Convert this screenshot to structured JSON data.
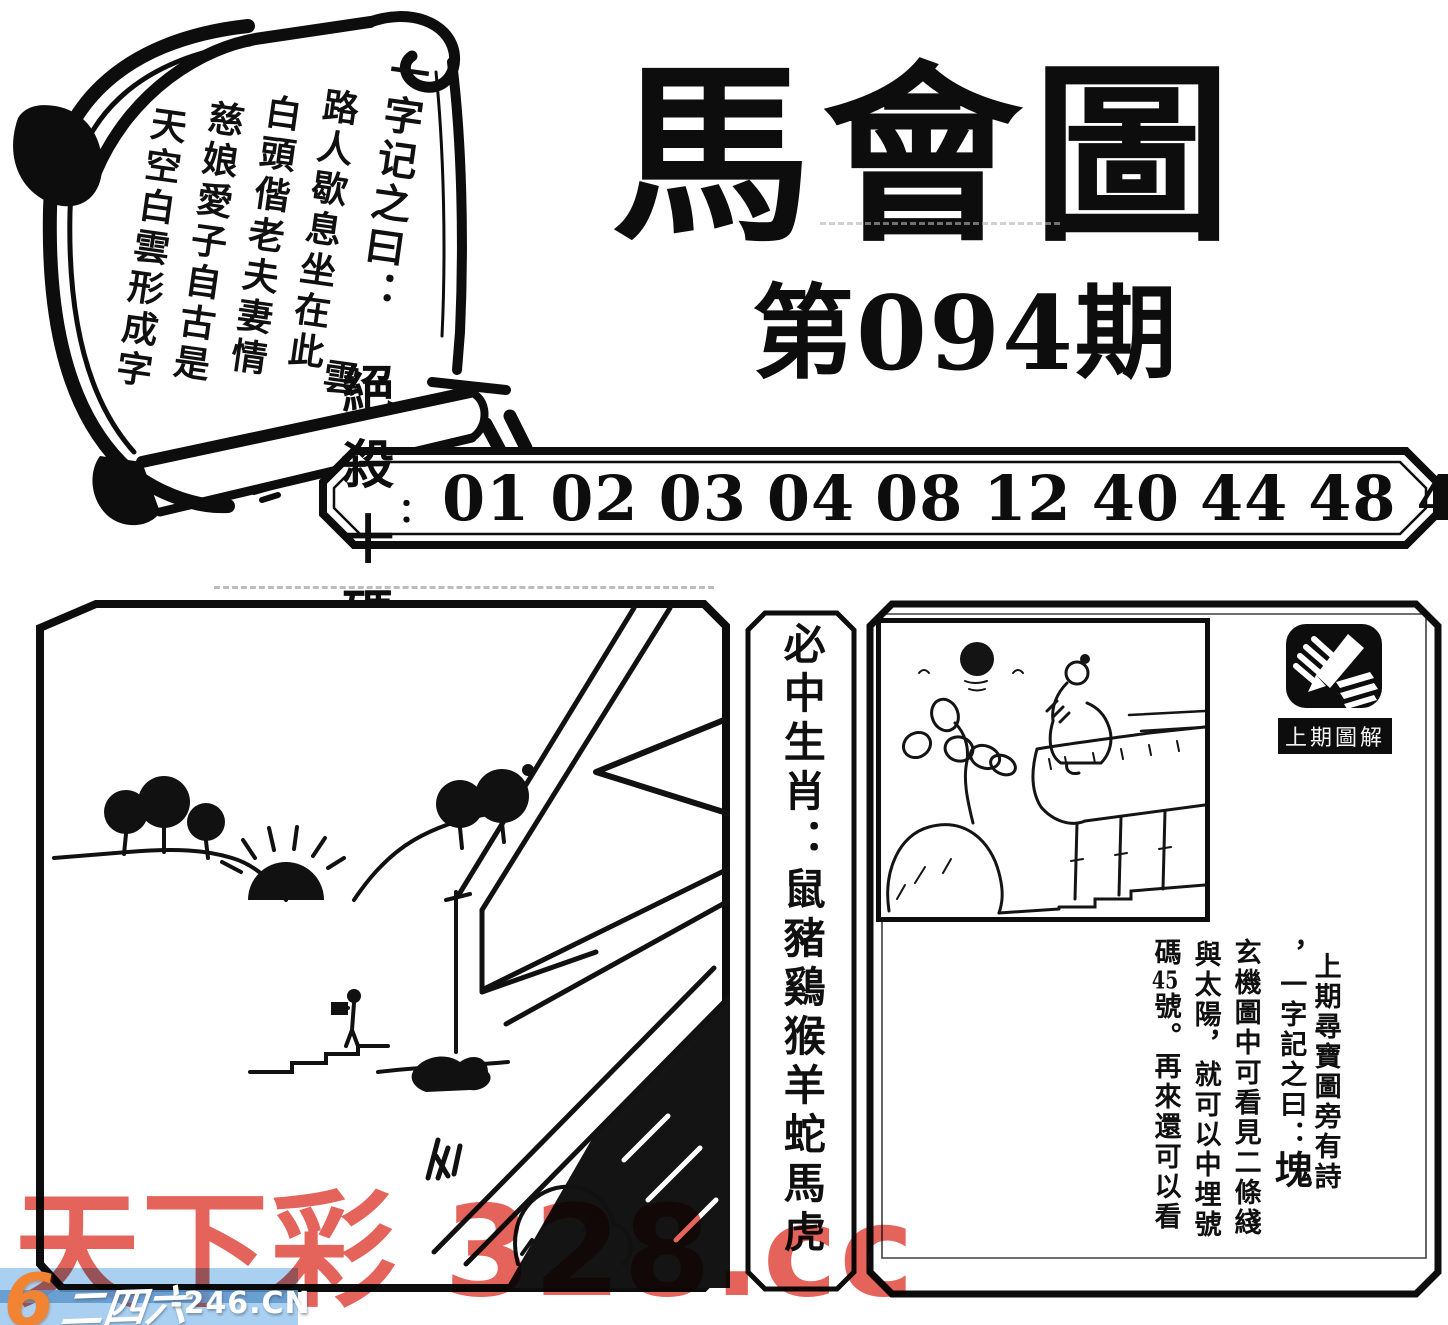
{
  "page": {
    "background": "#ffffff",
    "ink": "#0d0d0d"
  },
  "scroll": {
    "heading": "一字记之曰：",
    "answer": "雲",
    "poem": [
      "路人歇息坐在此",
      "白頭偕老夫妻情",
      "慈娘愛子自古是",
      "天空白雲形成字"
    ]
  },
  "title": {
    "main": "馬會圖",
    "issue": "第094期"
  },
  "banner": {
    "label": "絕殺十碼",
    "colon": "：",
    "numbers": [
      "01",
      "02",
      "03",
      "04",
      "08",
      "12",
      "40",
      "44",
      "48",
      "49"
    ]
  },
  "zodiac_strip": {
    "text": "必中生肖：鼠豬鷄猴羊蛇馬虎"
  },
  "right_panel": {
    "icon_label": "上期圖解",
    "columns": {
      "col1": "上期尋寶圖旁有詩",
      "col2_prefix": "，一字記之曰：",
      "col2_answer": "塊",
      "col3": "玄機圖中可看見二條綫",
      "col4": "與太陽，就可以中埋號",
      "col5_prefix": "碼",
      "col5_number": "45",
      "col5_suffix": "號。再來還可以看"
    }
  },
  "watermark": {
    "text": "天下彩 328.cc",
    "color": "#e2574e"
  },
  "site_logo": {
    "six": "6",
    "name": "二四六",
    "domain": "-246.CN",
    "bar_color": "#a3cdf0"
  }
}
